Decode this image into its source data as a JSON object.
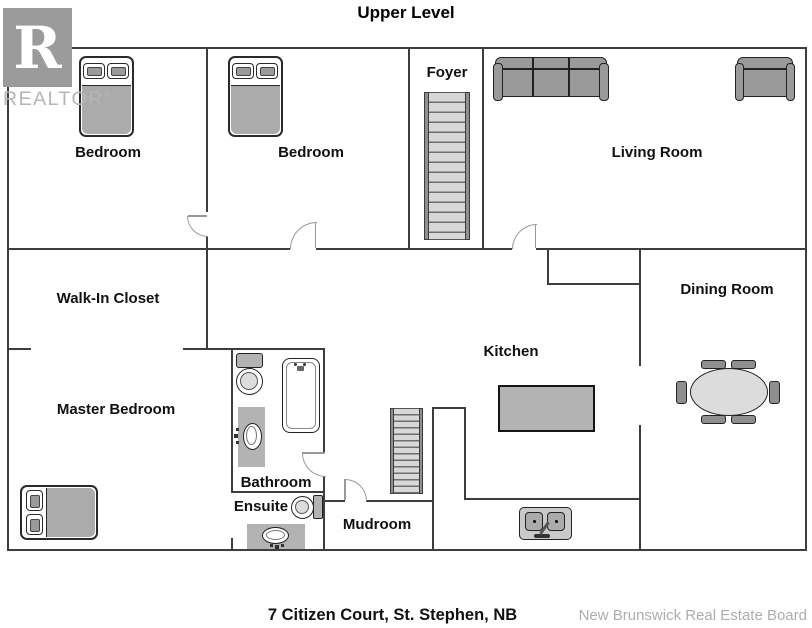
{
  "title": "Upper Level",
  "watermark": {
    "logo_letter": "R",
    "logo_text": "REALTOR",
    "registered": "®"
  },
  "rooms": [
    {
      "name": "Bedroom"
    },
    {
      "name": "Bedroom"
    },
    {
      "name": "Foyer"
    },
    {
      "name": "Living Room"
    },
    {
      "name": "Walk-In Closet"
    },
    {
      "name": "Dining Room"
    },
    {
      "name": "Kitchen"
    },
    {
      "name": "Master Bedroom"
    },
    {
      "name": "Bathroom"
    },
    {
      "name": "Ensuite"
    },
    {
      "name": "Mudroom"
    }
  ],
  "footer": {
    "address": "7 Citizen Court, St. Stephen, NB",
    "board": "New Brunswick Real Estate Board"
  },
  "colors": {
    "wall": "#3e3e3e",
    "door": "#999999",
    "furniture_gray": "#9a9a9a",
    "fixture_fill": "#b3b3b3",
    "stair_tread": "#d8d8d8",
    "label": "#111111",
    "footer_muted": "#adadad",
    "logo_gray": "#9b9b9b"
  }
}
